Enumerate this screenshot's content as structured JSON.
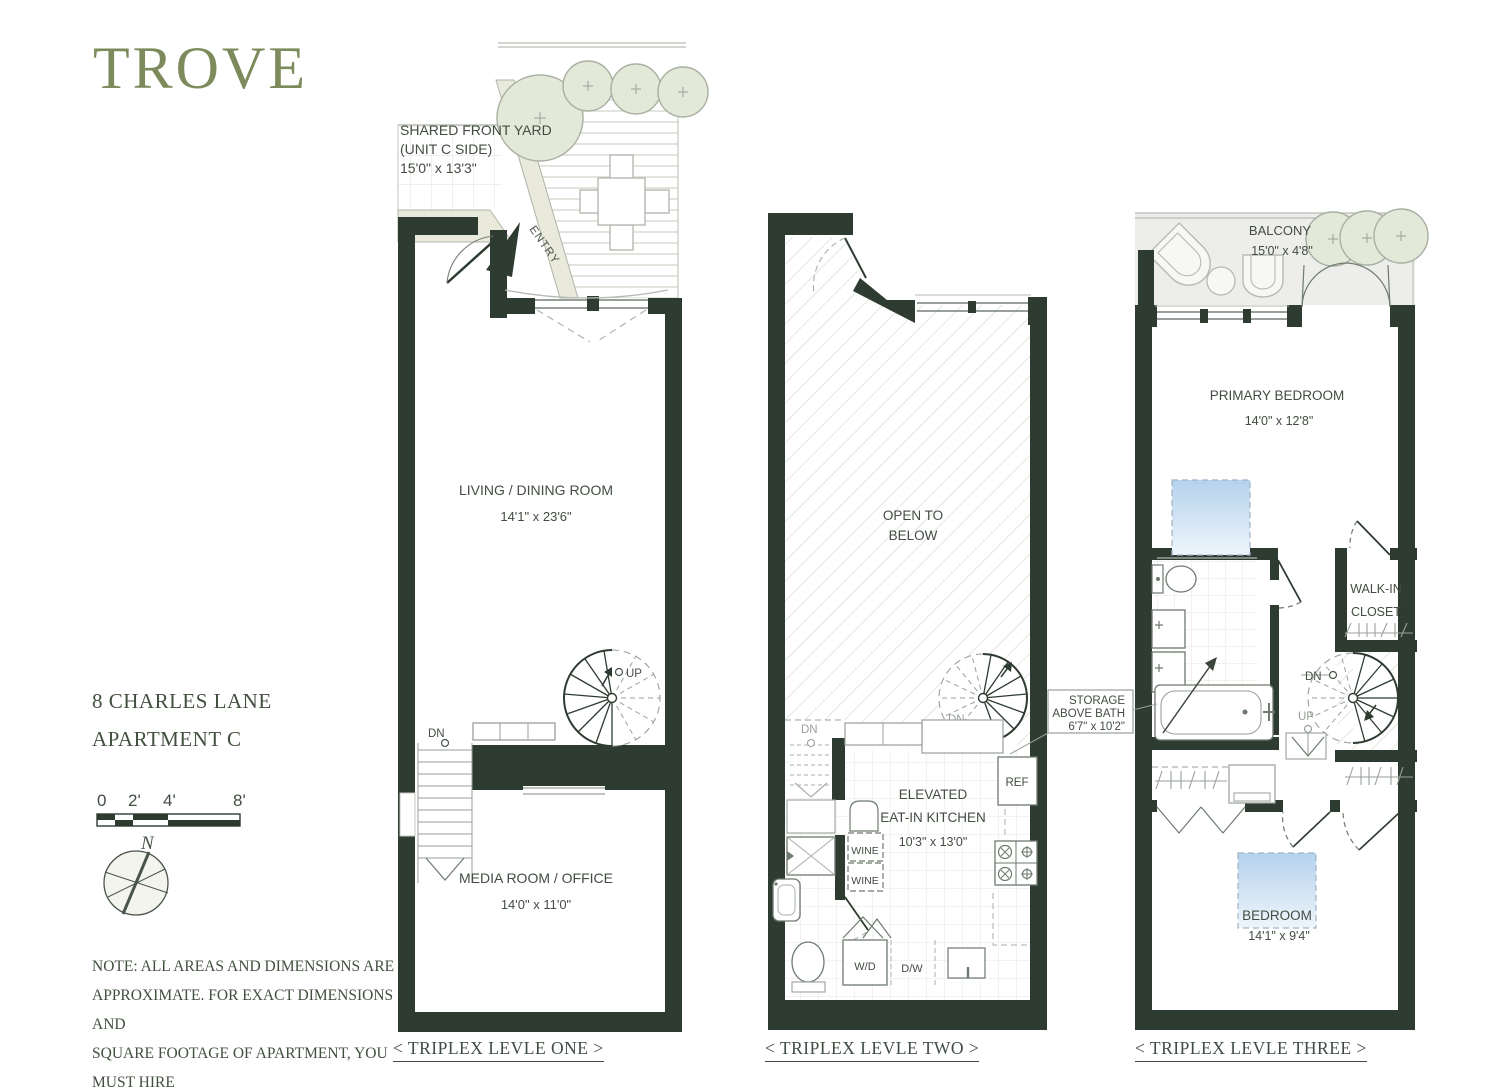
{
  "brand": {
    "logo": "TROVE"
  },
  "project": {
    "address_line1": "8 CHARLES LANE",
    "address_line2": "APARTMENT C"
  },
  "scale_bar": {
    "t0": "0",
    "t1": "2'",
    "t2": "4'",
    "t3": "8'"
  },
  "compass": {
    "label": "N"
  },
  "note": {
    "line1": "NOTE: ALL AREAS AND DIMENSIONS ARE",
    "line2": "APPROXIMATE. FOR EXACT DIMENSIONS AND",
    "line3": "SQUARE FOOTAGE OF APARTMENT, YOU MUST HIRE",
    "line4": "YOUR OWN ARCHITECT OR ENGINEER."
  },
  "levels": {
    "one": {
      "caption": "< TRIPLEX LEVLE ONE >",
      "yard_name1": "SHARED FRONT YARD",
      "yard_name2": "(UNIT C SIDE)",
      "yard_dims": "15'0\" x 13'3\"",
      "entry": "ENTRY",
      "living_name": "LIVING / DINING ROOM",
      "living_dims": "14'1\" x 23'6\"",
      "media_name": "MEDIA ROOM / OFFICE",
      "media_dims": "14'0\" x 11'0\"",
      "up": "UP",
      "dn": "DN"
    },
    "two": {
      "caption": "< TRIPLEX LEVLE TWO >",
      "open1": "OPEN TO",
      "open2": "BELOW",
      "kitchen1": "ELEVATED",
      "kitchen2": "EAT-IN KITCHEN",
      "kitchen_dims": "10'3\" x 13'0\"",
      "ref": "REF",
      "wine1": "WINE",
      "wine2": "WINE",
      "wd": "W/D",
      "dw": "D/W",
      "dn_stair": "DN",
      "dn_spiral": "DN",
      "up_spiral": "UP"
    },
    "three": {
      "caption": "< TRIPLEX LEVLE THREE >",
      "balcony_name": "BALCONY",
      "balcony_dims": "15'0\" x 4'8\"",
      "primary_name": "PRIMARY BEDROOM",
      "primary_dims": "14'0\" x 12'8\"",
      "walkin1": "WALK-IN",
      "walkin2": "CLOSET",
      "storage1": "STORAGE",
      "storage2": "ABOVE BATH",
      "storage_dims": "6'7\" x 10'2\"",
      "bedroom_name": "BEDROOM",
      "bedroom_dims": "14'1\" x 9'4\"",
      "dn": "DN",
      "up": "UP"
    }
  },
  "colors": {
    "wall": "#2e3b31",
    "olive": "#7d8b5c",
    "skylight": "#b5d2ec"
  }
}
